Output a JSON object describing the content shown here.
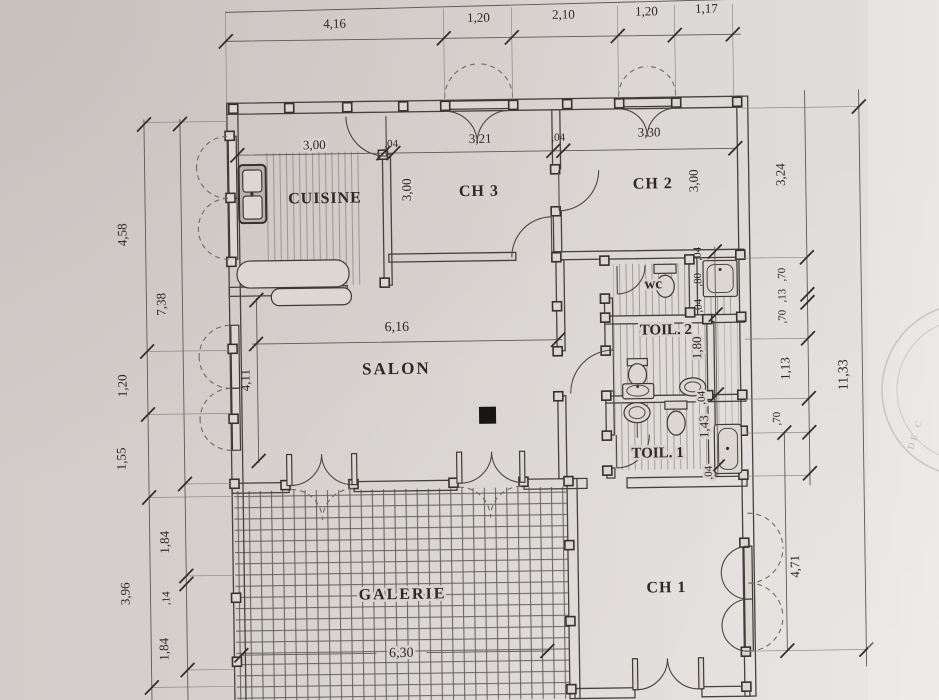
{
  "rooms": {
    "cuisine": "CUISINE",
    "ch3": "CH 3",
    "ch2": "CH 2",
    "salon": "SALON",
    "wc": "wc",
    "toil2": "TOIL.  2",
    "toil1": "TOIL.  1",
    "galerie": "GALERIE",
    "ch1": "CH 1"
  },
  "dims": {
    "top": [
      "4,16",
      "1,20",
      "2,10",
      "1,20",
      "1,17"
    ],
    "interior_top": [
      "3,00",
      ",04",
      "3,21",
      ",04",
      "3,30"
    ],
    "left_outer": [
      "4,58",
      "1,20",
      "1,55",
      "3,96"
    ],
    "left_inner": [
      "7,38",
      "1,84",
      ",14",
      "1,84"
    ],
    "right_inner": [
      "3,24",
      ",70",
      ",13",
      ",70",
      "1,13",
      ",70"
    ],
    "right_outer": [
      "11,33"
    ],
    "wc_chain": [
      ",04",
      ",80",
      ",04"
    ],
    "toilet_chain": [
      "1,80",
      ",04",
      "1,43",
      ",04"
    ],
    "ch3_height": "3,00",
    "ch2_height": "3,00",
    "salon_width": "6,16",
    "salon_left": "4,11",
    "galerie_width": "6,30",
    "ch1_right": "4,71"
  },
  "stamp": {
    "text": "DE C"
  },
  "colors": {
    "paper": "#d8d3d0",
    "ink": "#45423e"
  }
}
